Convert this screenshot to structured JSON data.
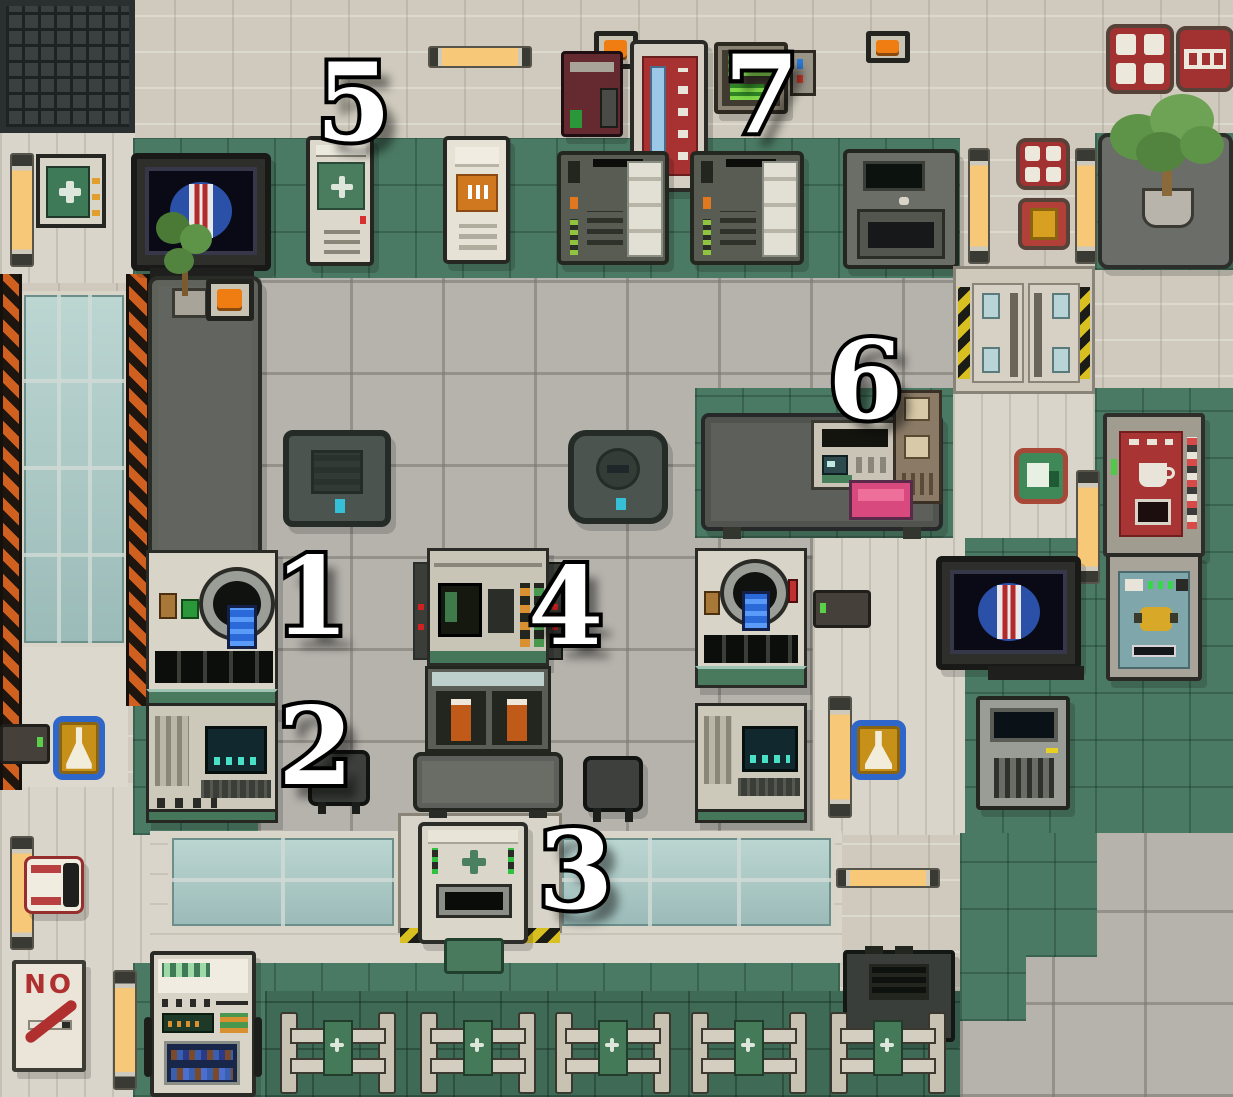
{
  "scene": {
    "name": "space-station-chemistry-medbay",
    "description": "Top-down pixel-art game screenshot of a chemistry/pharmacy lab with numbered machine callouts",
    "width_px": 1233,
    "height_px": 1097
  },
  "markers": [
    {
      "label": "1",
      "target": "reagent-grinder-station"
    },
    {
      "label": "2",
      "target": "chemistry-console"
    },
    {
      "label": "3",
      "target": "medicine-output-machine"
    },
    {
      "label": "4",
      "target": "chem-dispenser"
    },
    {
      "label": "5",
      "target": "medicine-locker"
    },
    {
      "label": "6",
      "target": "office-desk-with-fax"
    },
    {
      "label": "7",
      "target": "wall-mounted-green-terminal"
    }
  ],
  "signs": {
    "no_smoking_text": "NO"
  },
  "icons": {
    "medical_cross": "plus-shape",
    "chemistry_flask": "erlenmeyer-flask",
    "station_logo": "blue-circle-red-white-stripes"
  },
  "palette": {
    "floor_green": "#4b7a64",
    "wall_green_dark": "#3f6a56",
    "floor_gray": "#b6b3ad",
    "wall_beige": "#cfcabd",
    "corridor_white": "#d9d5ca",
    "hazard_orange": "#d06020",
    "hazard_yellow": "#d8c020",
    "window_teal": "#a9c7c4",
    "accent_green": "#45765a",
    "sign_red": "#a23131",
    "chem_sign_blue": "#2f66c9",
    "chem_sign_gold": "#c79018",
    "light_glow": "#f7c878",
    "led_green": "#8fc43e",
    "logo_blue": "#2a50a8",
    "beaker_blue": "#2a6ad8",
    "folder_pink": "#e05a8a",
    "bottle_orange": "#c05a18"
  }
}
